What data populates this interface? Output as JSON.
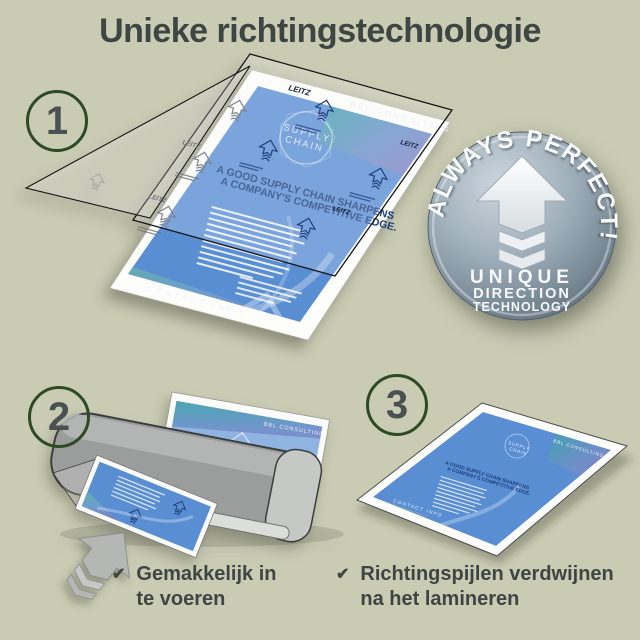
{
  "title": "Unieke richtingstechnologie",
  "steps": {
    "step1": "1",
    "step2": "2",
    "step3": "3"
  },
  "badge": {
    "arc_text": "ALWAYS PERFECT!",
    "line1": "UNIQUE",
    "line2": "DIRECTION",
    "line3": "TECHNOLOGY"
  },
  "doc": {
    "brand": "BBL CONSULTING",
    "logo_line1": "SUPPLY",
    "logo_line2": "CHAIN",
    "headline_line1": "A GOOD SUPPLY CHAIN SHARPENS",
    "headline_line2": "A COMPANY'S COMPETITIVE EDGE.",
    "footer": "CONTACT INFO",
    "pouch_brand": "LEITZ"
  },
  "checklist": {
    "check_icon": "✔",
    "items": [
      {
        "line1": "Gemakkelijk in",
        "line2": "te voeren"
      },
      {
        "line1": "Richtingspijlen verdwijnen",
        "line2": "na het lamineren"
      }
    ]
  },
  "colors": {
    "background": "#cacbb3",
    "text": "#3e4643",
    "step_ring_green": "#2c4a23",
    "step_number_gray": "#4b5052",
    "document_blue": "#5a8ed3",
    "headline_navy": "#1d3e7c",
    "badge_steel": "#8fa0ac",
    "laminator_gray": "#9b9d9c"
  }
}
